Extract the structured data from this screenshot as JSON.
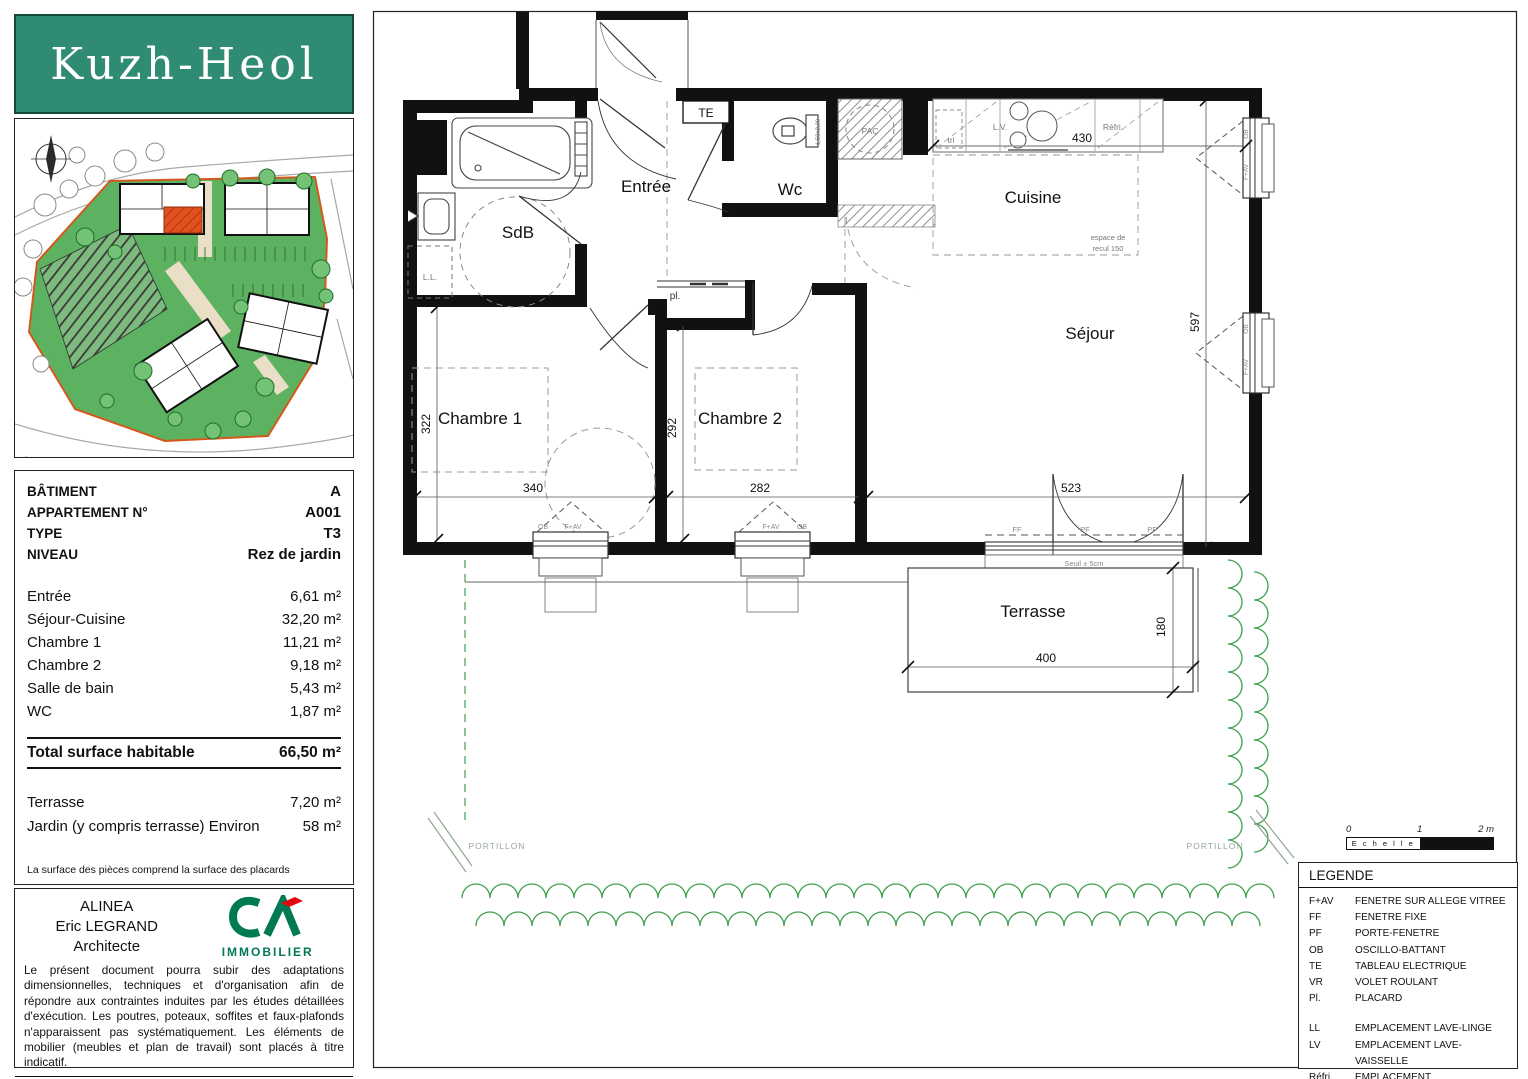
{
  "logo": {
    "text": "Kuzh-Heol",
    "bg_color": "#2f8b74"
  },
  "info": {
    "header": [
      {
        "label": "BÂTIMENT",
        "value": "A"
      },
      {
        "label": "APPARTEMENT N°",
        "value": "A001"
      },
      {
        "label": "TYPE",
        "value": "T3"
      },
      {
        "label": "NIVEAU",
        "value": "Rez de jardin"
      }
    ],
    "rooms": [
      {
        "label": "Entrée",
        "value": "6,61 m²"
      },
      {
        "label": "Séjour-Cuisine",
        "value": "32,20 m²"
      },
      {
        "label": "Chambre 1",
        "value": "11,21 m²"
      },
      {
        "label": "Chambre 2",
        "value": "9,18 m²"
      },
      {
        "label": "Salle de bain",
        "value": "5,43 m²"
      },
      {
        "label": "WC",
        "value": "1,87 m²"
      }
    ],
    "total": {
      "label": "Total surface habitable",
      "value": "66,50 m²"
    },
    "outdoor": [
      {
        "label": "Terrasse",
        "value": "7,20 m²"
      },
      {
        "label": "Jardin (y compris terrasse) Environ",
        "value": "58 m²"
      }
    ],
    "footnote": "La surface des pièces comprend la surface des placards"
  },
  "architect": {
    "line1": "ALINEA",
    "line2": "Eric LEGRAND",
    "line3": "Architecte",
    "brand": "IMMOBILIER",
    "disclaimer": "Le présent document pourra subir des adaptations dimensionnelles, techniques et d'organisation afin de répondre aux contraintes induites par les études détaillées d'exécution. Les poutres, poteaux, soffites et faux-plafonds n'apparaissent pas systématiquement. Les éléments de mobilier (meubles et plan de travail) sont placés à titre indicatif.",
    "date": "Date : 1er Février 2025"
  },
  "plan": {
    "rooms": {
      "entree": "Entrée",
      "sdb": "SdB",
      "wc": "Wc",
      "cuisine": "Cuisine",
      "sejour": "Séjour",
      "ch1": "Chambre 1",
      "ch2": "Chambre 2",
      "terrasse": "Terrasse"
    },
    "labels": {
      "te": "TE",
      "pac": "PAC",
      "tri": "tri",
      "lv": "L.V.",
      "refri": "Réfri.",
      "ll": "L.L.",
      "pl": "pl.",
      "espace1": "espace de",
      "espace2": "recul 150",
      "seuil": "Seuil ± 5cm",
      "ff": "FF",
      "pf": "PF",
      "ob": "OB",
      "fav": "F+AV",
      "portillon": "PORTILLON",
      "wc_note": "1,50x2,20"
    },
    "dims": {
      "d322": "322",
      "d340": "340",
      "d292": "292",
      "d282": "282",
      "d523": "523",
      "d597": "597",
      "d430": "430",
      "d400": "400",
      "d180": "180"
    }
  },
  "legend": {
    "title": "LEGENDE",
    "group1": [
      {
        "abbr": "F+AV",
        "label": "FENETRE SUR ALLEGE VITREE"
      },
      {
        "abbr": "FF",
        "label": "FENETRE FIXE"
      },
      {
        "abbr": "PF",
        "label": "PORTE-FENETRE"
      },
      {
        "abbr": "OB",
        "label": "OSCILLO-BATTANT"
      },
      {
        "abbr": "TE",
        "label": "TABLEAU ELECTRIQUE"
      },
      {
        "abbr": "VR",
        "label": "VOLET ROULANT"
      },
      {
        "abbr": "Pl.",
        "label": "PLACARD"
      }
    ],
    "group2": [
      {
        "abbr": "LL",
        "label": "EMPLACEMENT LAVE-LINGE"
      },
      {
        "abbr": "LV",
        "label": "EMPLACEMENT LAVE-VAISSELLE"
      },
      {
        "abbr": "Réfri.",
        "label": "EMPLACEMENT REFRIGERATEUR"
      },
      {
        "abbr": "",
        "label": "FAUX-PLAFOND OU SOFFITE"
      }
    ]
  },
  "scale": {
    "t0": "0",
    "t1": "1",
    "t2": "2 m",
    "label": "E c h e l l e"
  }
}
